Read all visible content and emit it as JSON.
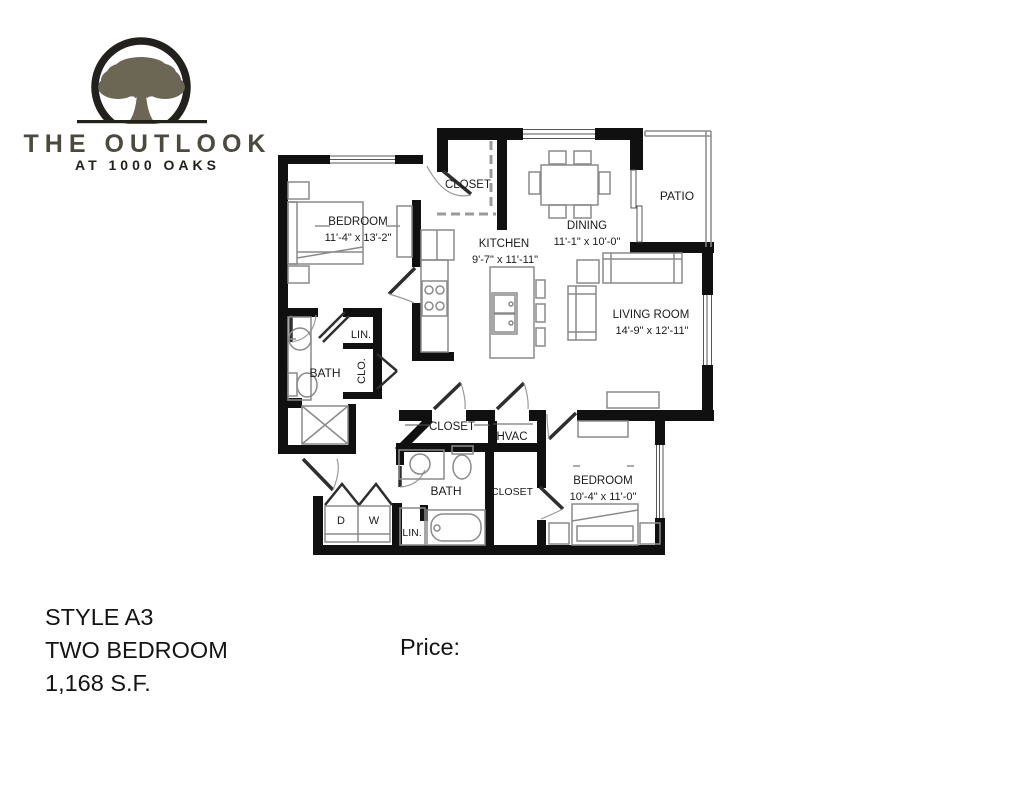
{
  "logo": {
    "brand_line1": "THE OUTLOOK",
    "brand_line2": "AT 1000 OAKS",
    "icon": "oak-tree-in-circle",
    "circle_color": "#22211e",
    "tree_color": "#6c6654",
    "brand_color": "#4b4940",
    "subbrand_color": "#201f1c"
  },
  "floorplan": {
    "wall_color": "#101010",
    "rooms": {
      "entry_closet": {
        "label": "CLOSET"
      },
      "bedroom1": {
        "label": "BEDROOM",
        "dims": "11'-4\" x 13'-2\""
      },
      "dining": {
        "label": "DINING",
        "dims": "11'-1\" x 10'-0\""
      },
      "patio": {
        "label": "PATIO"
      },
      "kitchen": {
        "label": "KITCHEN",
        "dims": "9'-7\" x 11'-11\""
      },
      "living": {
        "label": "LIVING ROOM",
        "dims": "14'-9\" x 12'-11\""
      },
      "linen1": {
        "label": "LIN."
      },
      "bath1": {
        "label": "BATH"
      },
      "clo": {
        "label": "CLO."
      },
      "hall_closet": {
        "label": "CLOSET"
      },
      "hvac": {
        "label": "HVAC"
      },
      "bath2": {
        "label": "BATH"
      },
      "walkin_closet": {
        "label": "CLOSET"
      },
      "bedroom2": {
        "label": "BEDROOM",
        "dims": "10'-4\" x 11'-0\""
      },
      "dryer": {
        "label": "D"
      },
      "washer": {
        "label": "W"
      },
      "linen2": {
        "label": "LIN."
      }
    }
  },
  "details": {
    "style": "STYLE A3",
    "type": "TWO BEDROOM",
    "area": "1,168 S.F.",
    "price_label": "Price:"
  }
}
